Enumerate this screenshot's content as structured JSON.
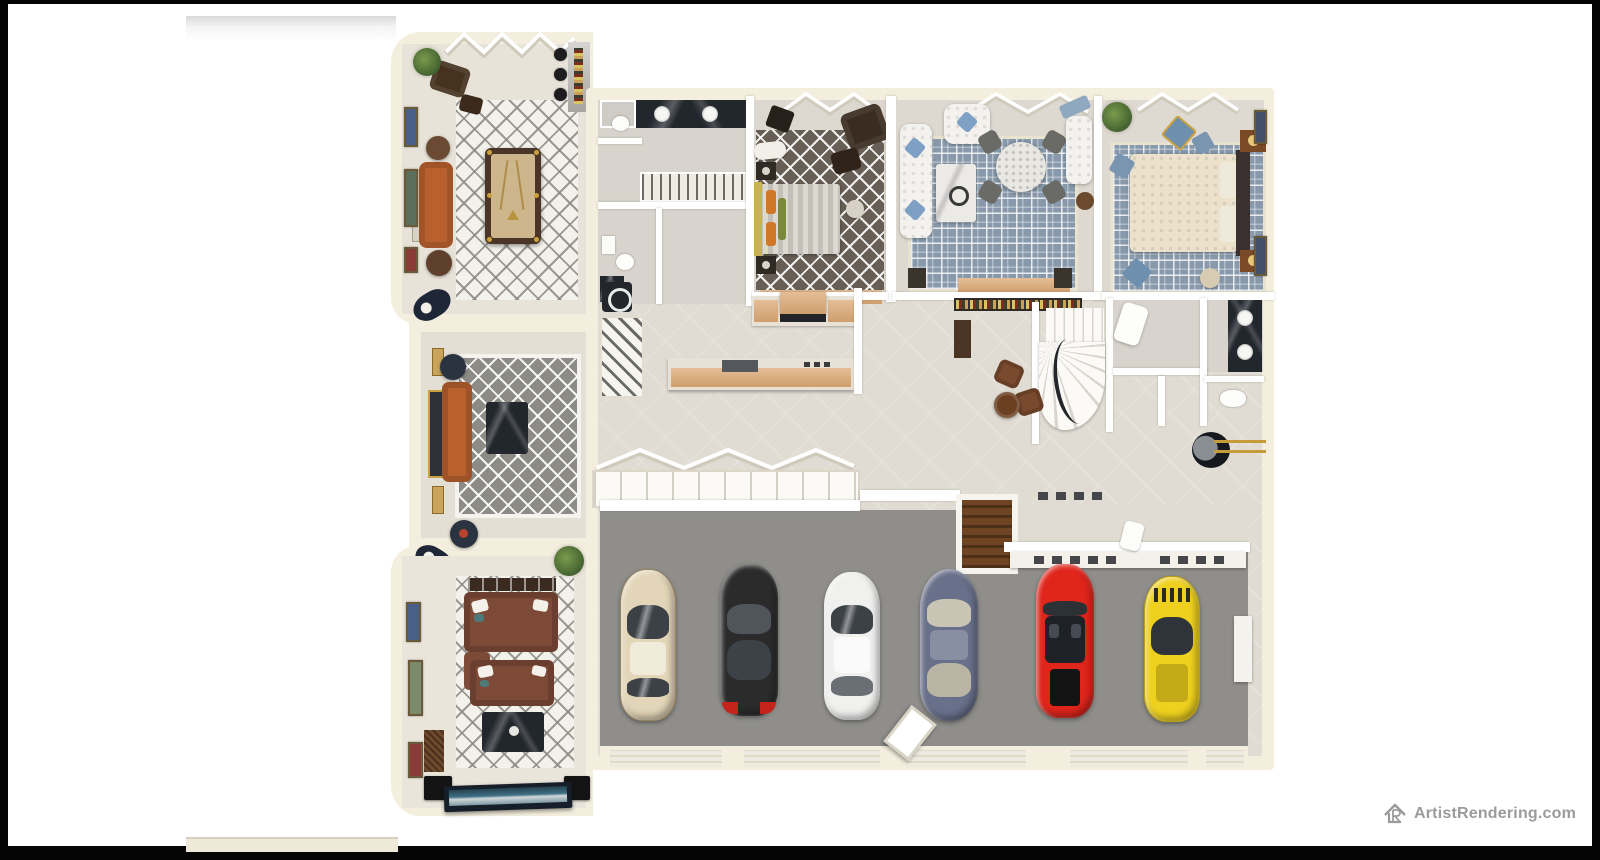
{
  "watermark": {
    "text": "ArtistRendering.com",
    "icon": "house-logo-icon",
    "color": "#9b9b9b"
  },
  "scene": {
    "type": "3d-floor-plan-top-down-rendering",
    "palette": {
      "outerWall": "#f3eedd",
      "interiorFloor": "#e0dcd3",
      "garageFloor": "#8f8e8b",
      "rugGray": "#8d8b85",
      "rugBrown": "#675e55",
      "rugBlue": "#8799ab",
      "rugWhite": "#f2f1ec",
      "sofaOrange": "#b9602f",
      "sofaTheaterBrown": "#7e4a38",
      "poolFelt": "#cdb68c",
      "kitchenWood": "#dca874",
      "marbleDark": "#23272e",
      "goldAccent": "#c69b3a"
    },
    "rooms": [
      {
        "id": "game-room",
        "name": "Billiards / Game Room",
        "furniture": [
          "pool-table",
          "orange-sofa",
          "console-table",
          "round-side-tables",
          "bar-counter",
          "wine-bottle-rack",
          "bar-stools",
          "armchair",
          "ottoman",
          "plant",
          "quatrefoil-rug",
          "folding-glass-doors",
          "wall-art"
        ]
      },
      {
        "id": "bath-suite",
        "name": "Bathroom Suite & Closets",
        "furniture": [
          "double-vanity-dark-marble",
          "shower",
          "toilet",
          "wardrobe-with-hangers",
          "second-toilet-room",
          "corner-vanity",
          "walk-in-closet"
        ]
      },
      {
        "id": "bedroom-1",
        "name": "Bedroom 1",
        "furniture": [
          "bed-gray-geometric-duvet",
          "orange-pillows",
          "dark-armchair",
          "ottoman",
          "nightstands",
          "brown-quatrefoil-rug",
          "open-casement-windows",
          "tan-dresser-row"
        ]
      },
      {
        "id": "sitting-room",
        "name": "Sitting / Living Room",
        "furniture": [
          "white-tufted-sofa",
          "white-armchair",
          "white-chaise",
          "blue-pillows",
          "marble-coffee-table",
          "round-dining-table",
          "four-gray-chairs",
          "blue-greek-key-rug",
          "wood-bench"
        ]
      },
      {
        "id": "bedroom-2",
        "name": "Bedroom 2",
        "furniture": [
          "cream-tufted-bed",
          "dark-headboard",
          "pillows",
          "wood-nightstands",
          "blue-greek-key-rug",
          "blue-pillows",
          "plant",
          "pouf",
          "wall-art"
        ]
      },
      {
        "id": "kitchen",
        "name": "Kitchen & Breakfast Nook",
        "furniture": [
          "wall-counter-with-range",
          "island-with-sink",
          "pantry-shelving",
          "washer",
          "bay-windows"
        ]
      },
      {
        "id": "stair-hall",
        "name": "Wine Bar & Curved Staircase",
        "furniture": [
          "wine-bottle-rack",
          "bar-cabinet",
          "curved-staircase",
          "two-leather-chairs",
          "round-wood-table"
        ]
      },
      {
        "id": "bath-2",
        "name": "Bathroom 2 / Utility",
        "furniture": [
          "dark-double-vanity",
          "toilet",
          "linen-closet",
          "water-heater",
          "gold-pipes"
        ]
      },
      {
        "id": "formal-living",
        "name": "Formal Living Room",
        "furniture": [
          "orange-chesterfield-sofa",
          "gold-framed-console",
          "dark-marble-coffee-table",
          "round-side-tables",
          "gray-quatrefoil-rug",
          "wall-niches",
          "crescent-decor"
        ]
      },
      {
        "id": "home-theater",
        "name": "Home Theater",
        "furniture": [
          "two-rows-brown-recliner-sofas",
          "white-pillows",
          "black-marble-table",
          "projection-screen",
          "speakers",
          "wall-art",
          "woven-panel",
          "plant",
          "quatrefoil-rug"
        ]
      },
      {
        "id": "mudroom",
        "name": "Mudroom / Storage",
        "furniture": [
          "stairwell-opening",
          "tool-shelf",
          "shoe-rows",
          "linens"
        ]
      },
      {
        "id": "garage",
        "name": "6-Car Garage",
        "furniture": [
          "workbench-with-tools",
          "garage-doors",
          "open-door-panel",
          "white-storage-cabinet"
        ]
      }
    ],
    "cars": [
      {
        "name": "champagne-sedan",
        "color": "#e3d6b8"
      },
      {
        "name": "black-sports-car",
        "color": "#2b2b2c"
      },
      {
        "name": "white-sedan",
        "color": "#f0f0ef"
      },
      {
        "name": "slate-blue-classic-car",
        "color": "#68708a"
      },
      {
        "name": "red-convertible",
        "color": "#e0251b"
      },
      {
        "name": "yellow-sports-car",
        "color": "#eed11e"
      }
    ]
  }
}
